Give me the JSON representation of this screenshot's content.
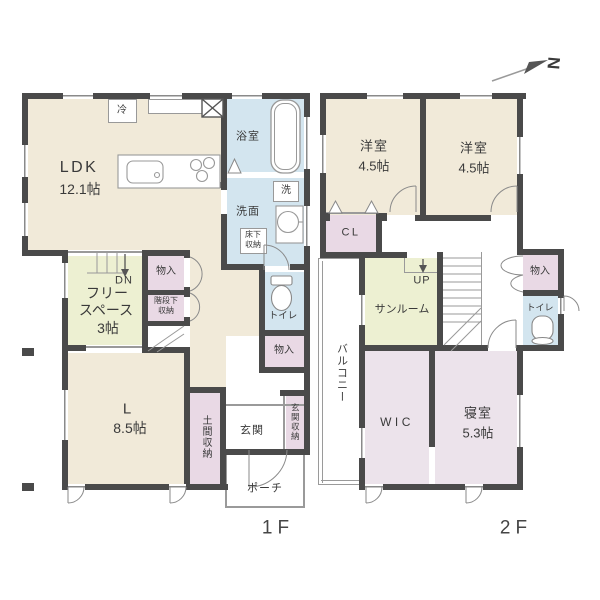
{
  "compass": {
    "label": "N"
  },
  "floor1": {
    "floor_label": "1F",
    "ldk": {
      "name": "LDK",
      "size": "12.1帖"
    },
    "fridge": "冷",
    "bath": "浴室",
    "washer": "洗",
    "washroom": "洗面",
    "underfloor_storage": [
      "床下",
      "収納"
    ],
    "free_space": {
      "line1": "フリー",
      "line2": "スペース",
      "size": "3帖"
    },
    "down": "DN",
    "stair_closet": "物入",
    "under_stair_storage": [
      "階段下",
      "収納"
    ],
    "toilet": "トイレ",
    "hall_closet": "物入",
    "living": {
      "name": "L",
      "size": "8.5帖"
    },
    "doma_storage": "土間収納",
    "entrance": "玄関",
    "entrance_storage": "玄関収納",
    "porch": "ポーチ"
  },
  "floor2": {
    "floor_label": "2F",
    "room_a": {
      "name": "洋室",
      "size": "4.5帖"
    },
    "room_b": {
      "name": "洋室",
      "size": "4.5帖"
    },
    "closet": "CL",
    "up": "UP",
    "sunroom": "サンルーム",
    "storage": "物入",
    "toilet": "トイレ",
    "balcony": "バルコニー",
    "wic": "WIC",
    "bedroom": {
      "name": "寝室",
      "size": "5.3帖"
    }
  },
  "colors": {
    "wall": "#4a4a4a",
    "room_cream": "#f1ead9",
    "wet_area_blue": "#d3e5ef",
    "free_space_green": "#edf0d2",
    "closet_pink": "#e9d9e5",
    "bedroom_pink": "#ece3eb",
    "line_gray": "#9a9a9a",
    "text": "#3a3a3a"
  }
}
